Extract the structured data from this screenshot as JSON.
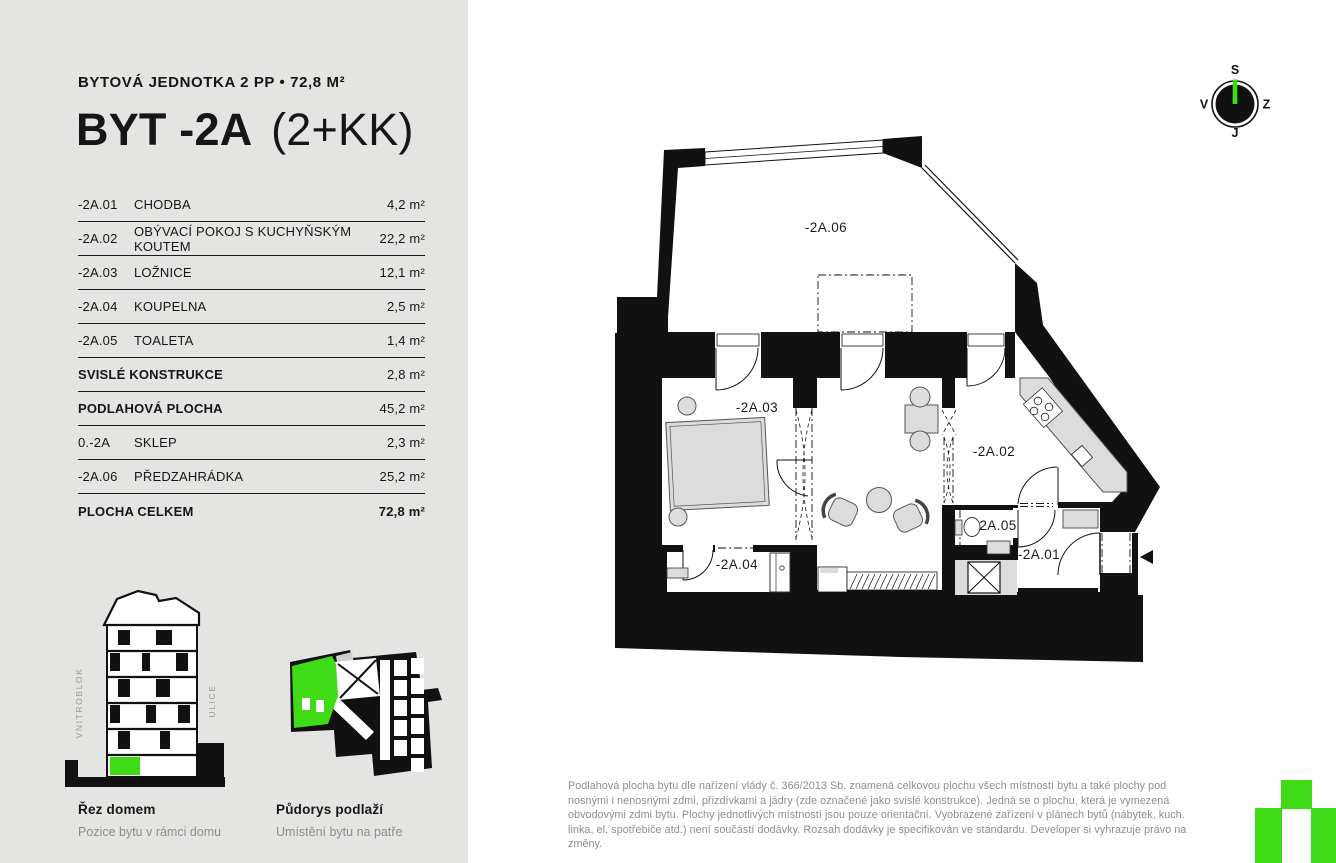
{
  "colors": {
    "accent_green": "#3edb16",
    "sidebar_bg": "#e4e4e2",
    "ink": "#161616",
    "muted_gray": "#8d8d8d"
  },
  "sidebar": {
    "subtitle": "BYTOVÁ JEDNOTKA 2 PP • 72,8 M²",
    "title": "BYT -2A",
    "title_suffix": "(2+KK)",
    "rooms": [
      {
        "code": "-2A.01",
        "name": "CHODBA",
        "area": "4,2 m²",
        "bold": false,
        "bold_area": false
      },
      {
        "code": "-2A.02",
        "name": "OBÝVACÍ POKOJ S KUCHYŇSKÝM KOUTEM",
        "area": "22,2 m²",
        "bold": false,
        "bold_area": false
      },
      {
        "code": "-2A.03",
        "name": "LOŽNICE",
        "area": "12,1 m²",
        "bold": false,
        "bold_area": false
      },
      {
        "code": "-2A.04",
        "name": "KOUPELNA",
        "area": "2,5 m²",
        "bold": false,
        "bold_area": false
      },
      {
        "code": "-2A.05",
        "name": "TOALETA",
        "area": "1,4 m²",
        "bold": false,
        "bold_area": false
      },
      {
        "code": "",
        "name": "SVISLÉ KONSTRUKCE",
        "area": "2,8 m²",
        "bold": true,
        "bold_area": false
      },
      {
        "code": "",
        "name": "PODLAHOVÁ PLOCHA",
        "area": "45,2 m²",
        "bold": true,
        "bold_area": false
      },
      {
        "code": "0.-2A",
        "name": "SKLEP",
        "area": "2,3 m²",
        "bold": false,
        "bold_area": false
      },
      {
        "code": "-2A.06",
        "name": "PŘEDZAHRÁDKA",
        "area": "25,2 m²",
        "bold": false,
        "bold_area": false
      },
      {
        "code": "",
        "name": "PLOCHA CELKEM",
        "area": "72,8 m²",
        "bold": true,
        "bold_area": true
      }
    ],
    "section_diagram": {
      "title": "Řez domem",
      "subtitle": "Pozice bytu v rámci domu",
      "label_left": "VNITROBLOK",
      "label_right": "ULICE"
    },
    "floorplate_diagram": {
      "title": "Půdorys podlaží",
      "subtitle": "Umístění bytu na patře"
    }
  },
  "compass": {
    "top": "S",
    "left": "V",
    "right": "Z",
    "bottom": "J"
  },
  "plan": {
    "labels": {
      "garden": "-2A.06",
      "bedroom": "-2A.03",
      "living": "-2A.02",
      "bathroom": "-2A.04",
      "toilet": "2A.05",
      "hallway": "-2A.01"
    }
  },
  "footer": {
    "disclaimer": "Podlahová plocha bytu dle nařízení vlády č. 366/2013 Sb. znamená celkovou plochu všech místností bytu a také plochy pod nosnými i nenosnými zdmi, přizdívkami a jádry (zde označené jako svislé konstrukce). Jedná se o plochu, která je vymezená obvodovými zdmi bytu. Plochy jednotlivých místností jsou pouze orientační. Vyobrazené zařízení v plánech bytů (nábytek, kuch. linka, el. spotřebiče atd.) není součástí dodávky. Rozsah dodávky je specifikován ve standardu. Developer si vyhrazuje právo na změny."
  }
}
